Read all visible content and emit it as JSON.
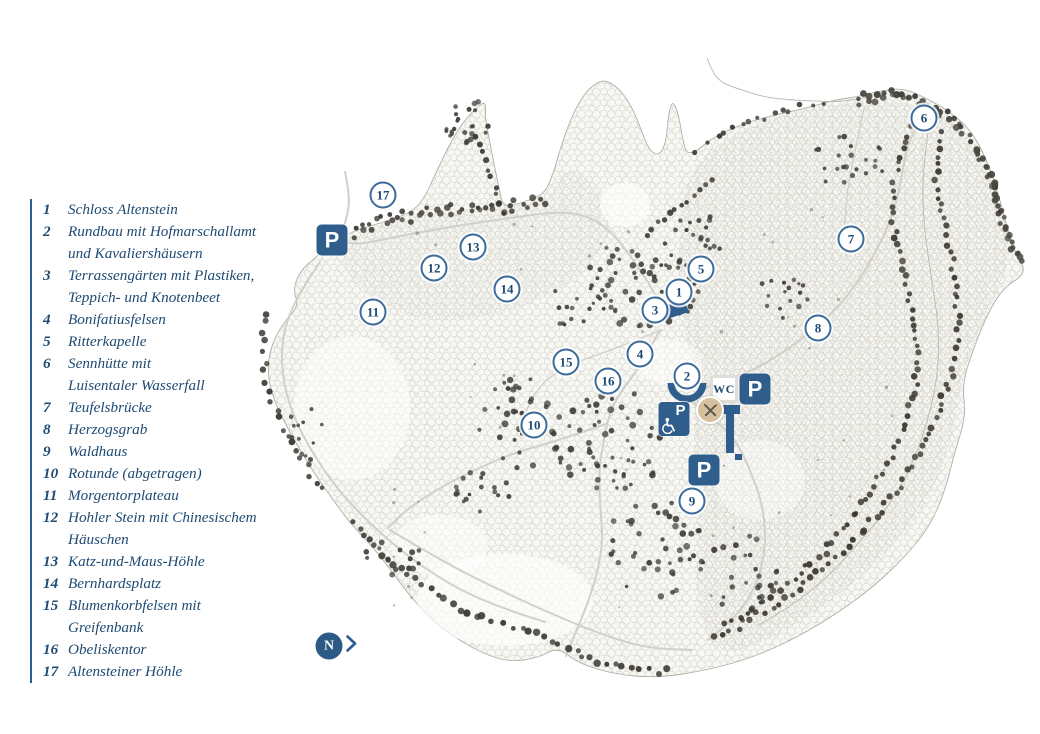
{
  "colors": {
    "legend_text": "#1e4a73",
    "icon_blue": "#2f5d8c",
    "marker_border": "#3c6b9a",
    "restaurant_tan": "#d7c09e"
  },
  "legend": {
    "items": [
      {
        "number": "1",
        "lines": [
          "Schloss Altenstein"
        ]
      },
      {
        "number": "2",
        "lines": [
          "Rundbau mit Hofmarschallamt",
          "und Kavaliershäusern"
        ]
      },
      {
        "number": "3",
        "lines": [
          "Terrassengärten mit Plastiken,",
          "Teppich- und Knotenbeet"
        ]
      },
      {
        "number": "4",
        "lines": [
          "Bonifatiusfelsen"
        ]
      },
      {
        "number": "5",
        "lines": [
          "Ritterkapelle"
        ]
      },
      {
        "number": "6",
        "lines": [
          "Sennhütte mit",
          "Luisentaler Wasserfall"
        ]
      },
      {
        "number": "7",
        "lines": [
          "Teufelsbrücke"
        ]
      },
      {
        "number": "8",
        "lines": [
          "Herzogsgrab"
        ]
      },
      {
        "number": "9",
        "lines": [
          "Waldhaus"
        ]
      },
      {
        "number": "10",
        "lines": [
          "Rotunde (abgetragen)"
        ]
      },
      {
        "number": "11",
        "lines": [
          "Morgentorplateau"
        ]
      },
      {
        "number": "12",
        "lines": [
          "Hohler Stein mit Chinesischem",
          "Häuschen"
        ]
      },
      {
        "number": "13",
        "lines": [
          "Katz-und-Maus-Höhle"
        ]
      },
      {
        "number": "14",
        "lines": [
          "Bernhardsplatz"
        ]
      },
      {
        "number": "15",
        "lines": [
          "Blumenkorbfelsen mit",
          "Greifenbank"
        ]
      },
      {
        "number": "16",
        "lines": [
          "Obeliskentor"
        ]
      },
      {
        "number": "17",
        "lines": [
          "Altensteiner Höhle"
        ]
      }
    ]
  },
  "map": {
    "markers": [
      {
        "n": "1",
        "x": 679,
        "y": 292
      },
      {
        "n": "2",
        "x": 687,
        "y": 376
      },
      {
        "n": "3",
        "x": 655,
        "y": 310
      },
      {
        "n": "4",
        "x": 640,
        "y": 354
      },
      {
        "n": "5",
        "x": 701,
        "y": 269
      },
      {
        "n": "6",
        "x": 924,
        "y": 118
      },
      {
        "n": "7",
        "x": 851,
        "y": 239
      },
      {
        "n": "8",
        "x": 818,
        "y": 328
      },
      {
        "n": "9",
        "x": 692,
        "y": 501
      },
      {
        "n": "10",
        "x": 534,
        "y": 425
      },
      {
        "n": "11",
        "x": 373,
        "y": 312
      },
      {
        "n": "12",
        "x": 434,
        "y": 268
      },
      {
        "n": "13",
        "x": 473,
        "y": 247
      },
      {
        "n": "14",
        "x": 507,
        "y": 289
      },
      {
        "n": "15",
        "x": 566,
        "y": 362
      },
      {
        "n": "16",
        "x": 608,
        "y": 381
      },
      {
        "n": "17",
        "x": 383,
        "y": 195
      }
    ],
    "parking_label": "P",
    "parking": [
      {
        "x": 332,
        "y": 240,
        "accessible": false
      },
      {
        "x": 755,
        "y": 389,
        "accessible": false
      },
      {
        "x": 674,
        "y": 419,
        "accessible": true
      },
      {
        "x": 704,
        "y": 470,
        "accessible": false
      }
    ],
    "wc": {
      "label": "WC",
      "x": 724,
      "y": 389
    },
    "restaurant": {
      "x": 710,
      "y": 410
    },
    "compass": {
      "label": "N",
      "x": 329,
      "y": 646
    }
  }
}
